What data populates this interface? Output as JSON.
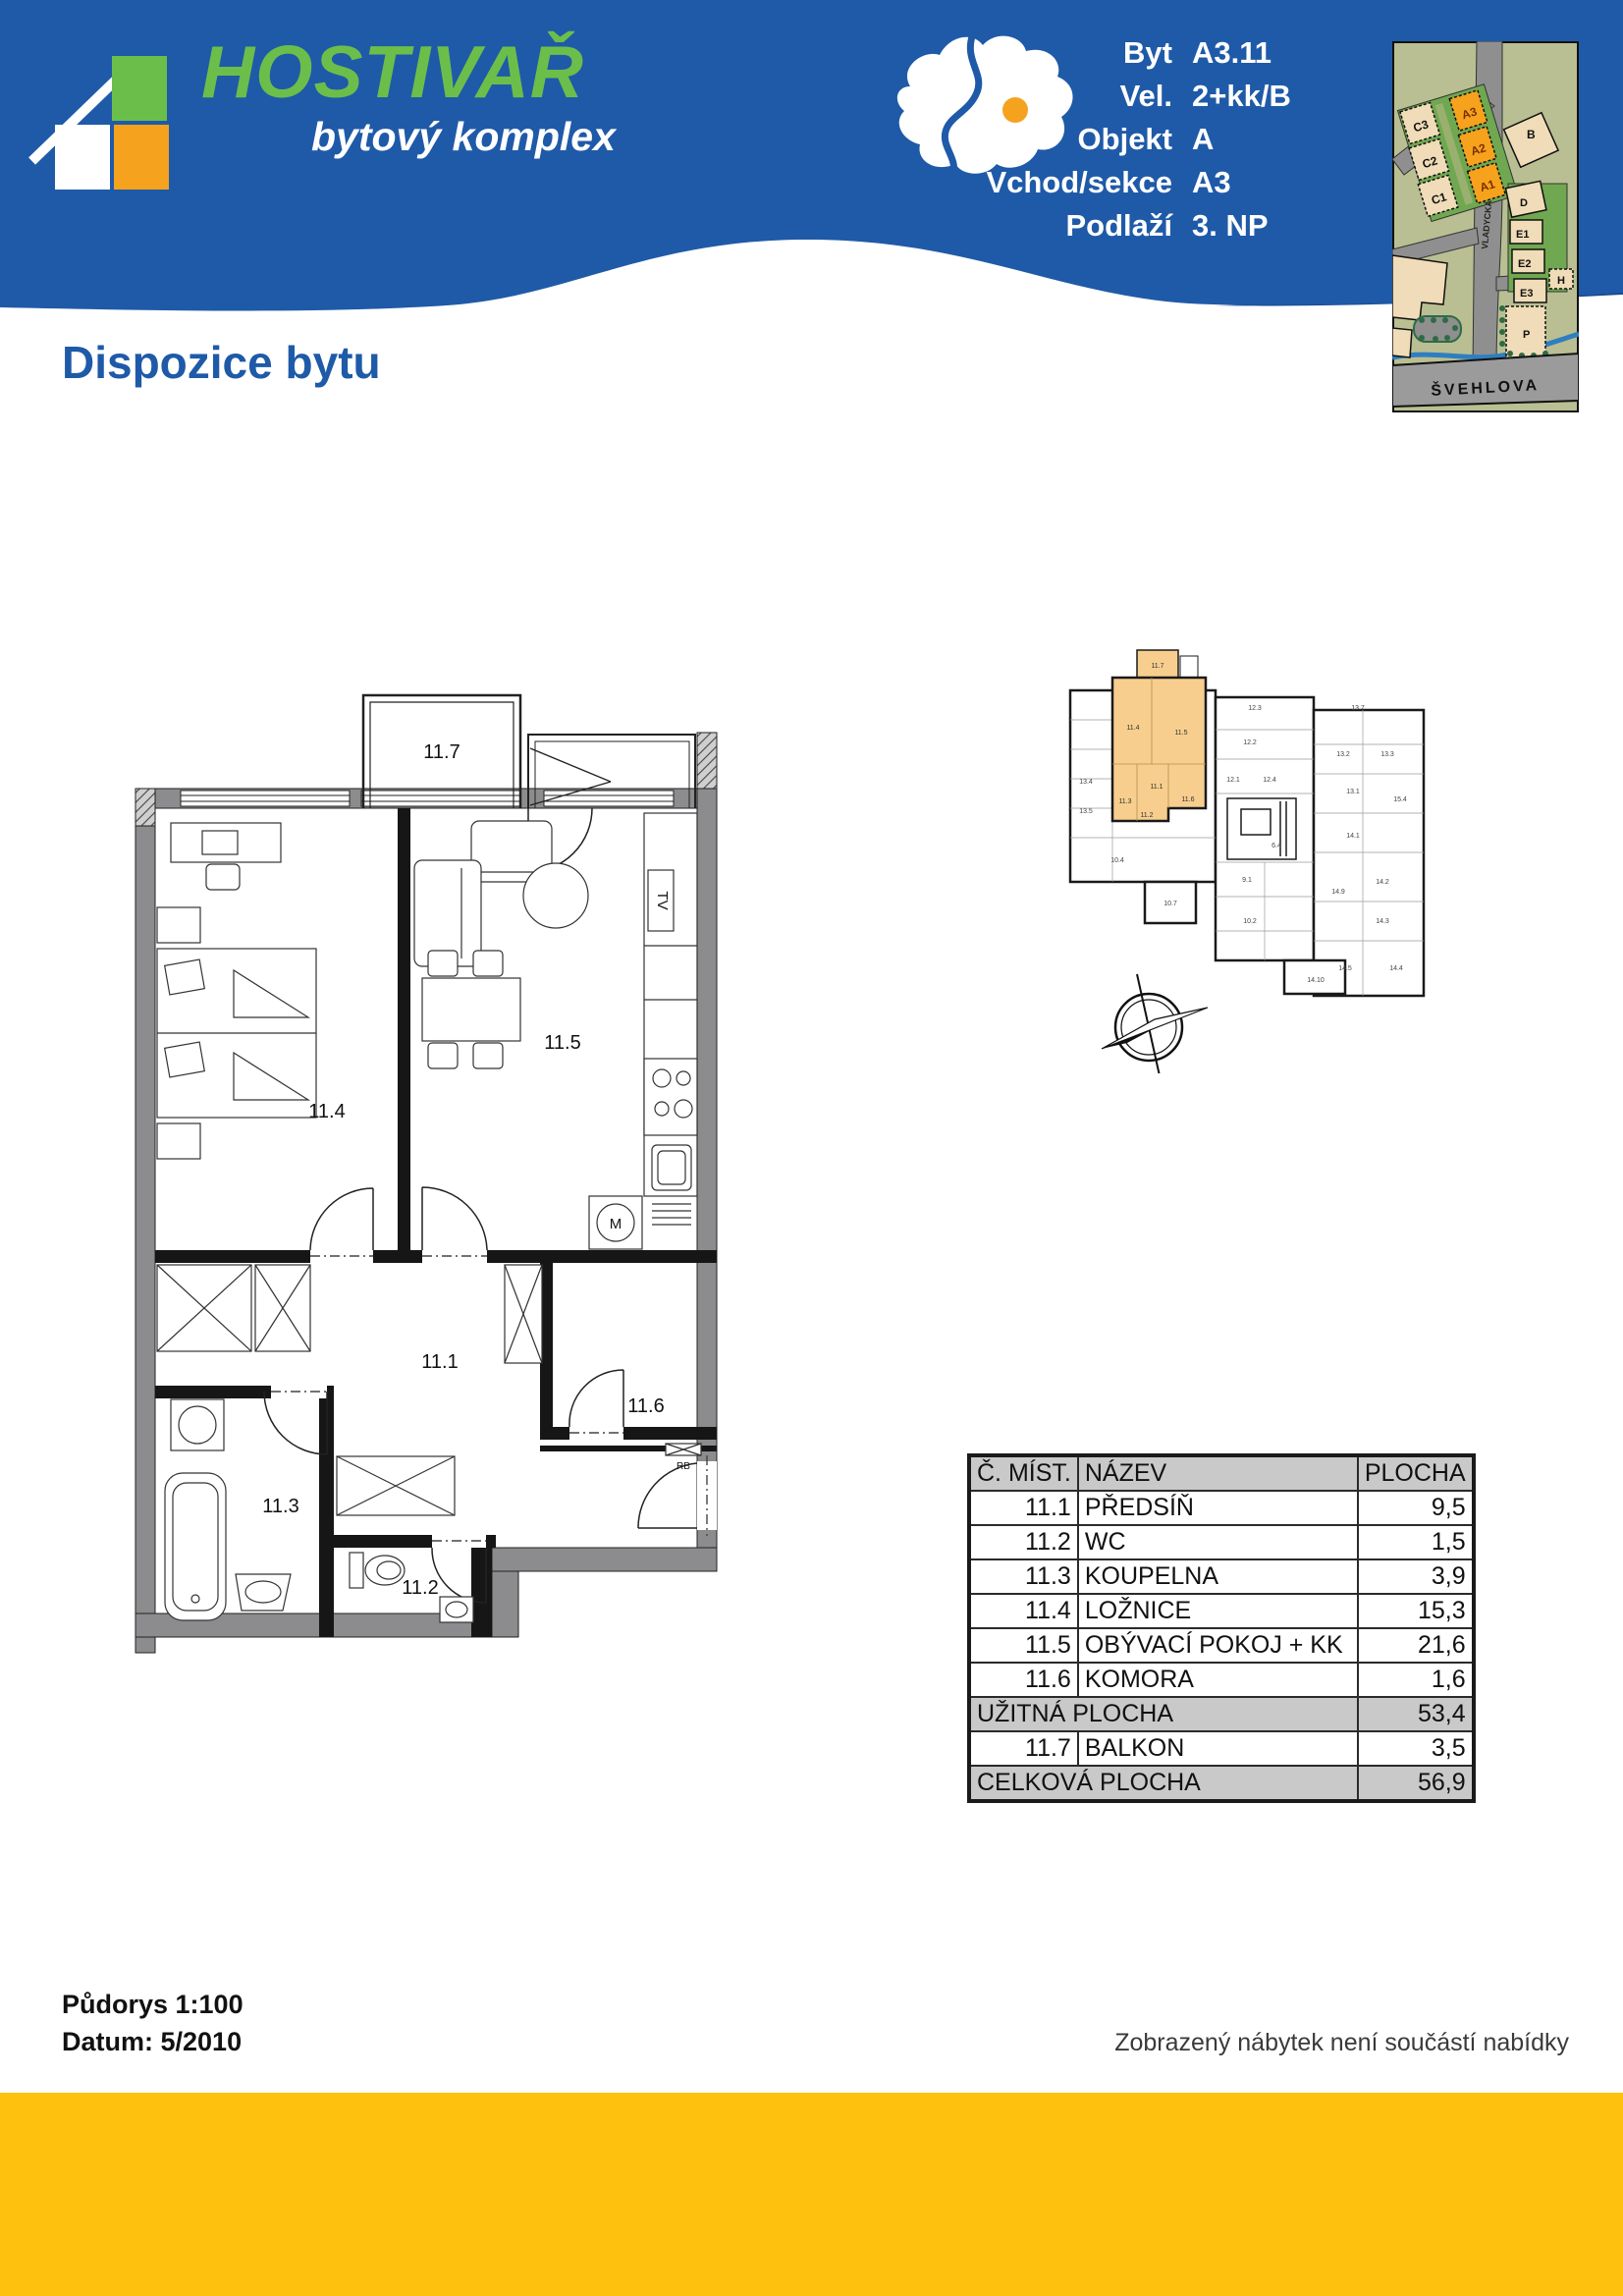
{
  "header": {
    "brand": {
      "title": "HOSTIVAŘ",
      "subtitle": "bytový komplex"
    },
    "info": [
      {
        "label": "Byt",
        "value": "A3.11"
      },
      {
        "label": "Vel.",
        "value": "2+kk/B"
      },
      {
        "label": "Objekt",
        "value": "A"
      },
      {
        "label": "Vchod/sekce",
        "value": "A3"
      },
      {
        "label": "Podlaží",
        "value": "3. NP"
      }
    ],
    "colors": {
      "blue": "#1f5aa8",
      "dark_blue": "#174a90",
      "green": "#6cbe4b",
      "orange": "#f5a21f"
    }
  },
  "page": {
    "title": "Dispozice bytu"
  },
  "site_map": {
    "street": "ŠVEHLOVA",
    "street2": "VLADYCKÁ",
    "buildings": [
      "C3",
      "C2",
      "C1",
      "A3",
      "A2",
      "A1",
      "B",
      "D",
      "E1",
      "E2",
      "E3",
      "P",
      "H"
    ],
    "highlight_color": "#f6a21d"
  },
  "plan": {
    "labels": {
      "balkon": "11.7",
      "loznice": "11.4",
      "obyvaci": "11.5",
      "predsin": "11.1",
      "komora": "11.6",
      "koupelna": "11.3",
      "wc": "11.2"
    },
    "tv": "TV",
    "m": "M",
    "rb": "RB"
  },
  "overview": {
    "highlight_color": "#f7ce8d",
    "labels": [
      "11.7",
      "11.4",
      "11.5",
      "11.1",
      "11.3",
      "11.2",
      "11.6",
      "12.3",
      "12.2",
      "12.1",
      "12.4",
      "13.7",
      "13.2",
      "13.3",
      "13.4",
      "13.5",
      "13.1",
      "15.4",
      "9.1",
      "6.4",
      "10.4",
      "10.7",
      "10.2",
      "14.1",
      "14.2",
      "14.3",
      "14.9",
      "14.5",
      "14.4",
      "14.10"
    ]
  },
  "table": {
    "headers": [
      "Č. MÍST.",
      "NÁZEV",
      "PLOCHA"
    ],
    "rows": [
      {
        "num": "11.1",
        "name": "PŘEDSÍŇ",
        "area": "9,5"
      },
      {
        "num": "11.2",
        "name": "WC",
        "area": "1,5"
      },
      {
        "num": "11.3",
        "name": "KOUPELNA",
        "area": "3,9"
      },
      {
        "num": "11.4",
        "name": "LOŽNICE",
        "area": "15,3"
      },
      {
        "num": "11.5",
        "name": "OBÝVACÍ POKOJ + KK",
        "area": "21,6"
      },
      {
        "num": "11.6",
        "name": "KOMORA",
        "area": "1,6"
      }
    ],
    "uzitna": {
      "label": "UŽITNÁ PLOCHA",
      "value": "53,4"
    },
    "balkon": {
      "num": "11.7",
      "name": "BALKON",
      "area": "3,5"
    },
    "celkova": {
      "label": "CELKOVÁ PLOCHA",
      "value": "56,9"
    }
  },
  "footer": {
    "scale": "Půdorys 1:100",
    "date": "Datum: 5/2010",
    "disclaimer": "Zobrazený nábytek není součástí nabídky",
    "bar_color": "#fec20e"
  }
}
